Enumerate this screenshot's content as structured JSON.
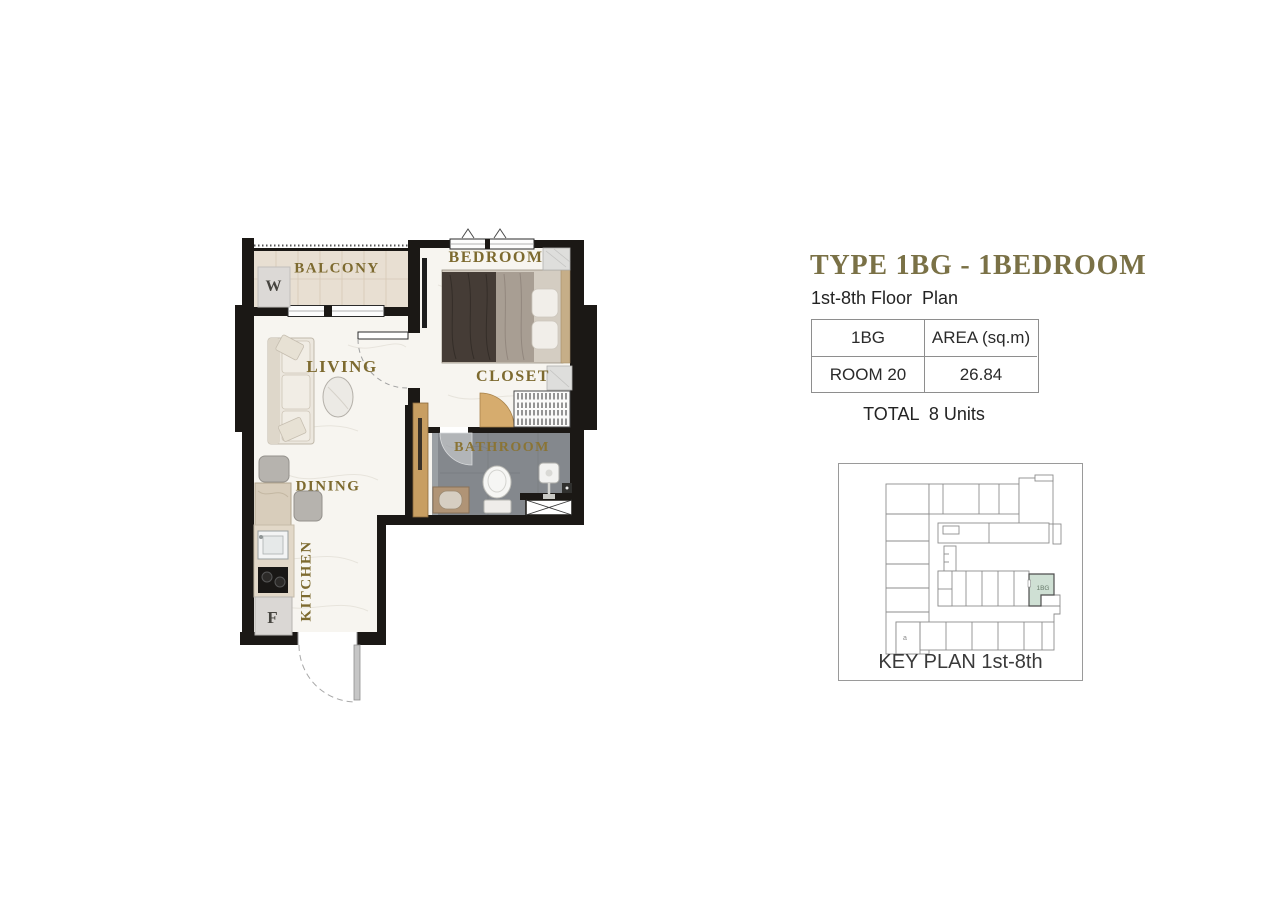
{
  "header": {
    "title": "TYPE 1BG - 1BEDROOM",
    "subtitle": "1st-8th Floor  Plan"
  },
  "area_table": {
    "col1_header": "1BG",
    "col2_header": "AREA (sq.m)",
    "col1_value": "ROOM 20",
    "col2_value": "26.84"
  },
  "total_line": "TOTAL  8 Units",
  "plan": {
    "labels": {
      "balcony": "BALCONY",
      "bedroom": "BEDROOM",
      "living": "LIVING",
      "closet": "CLOSET",
      "bathroom": "BATHROOM",
      "dining": "DINING",
      "kitchen": "KITCHEN",
      "washer": "W",
      "fridge": "F"
    }
  },
  "key_plan": {
    "caption": "KEY PLAN 1st-8th",
    "highlighted_unit": "1BG",
    "stair_label": "a",
    "highlight_color": "#cfe0d4"
  },
  "colors": {
    "title_gold": "#7a7146",
    "label_gold": "#7d6a2f",
    "wall_black": "#1b1815",
    "bathroom_gray": "#84888d",
    "wood_tan": "#c89e62"
  }
}
